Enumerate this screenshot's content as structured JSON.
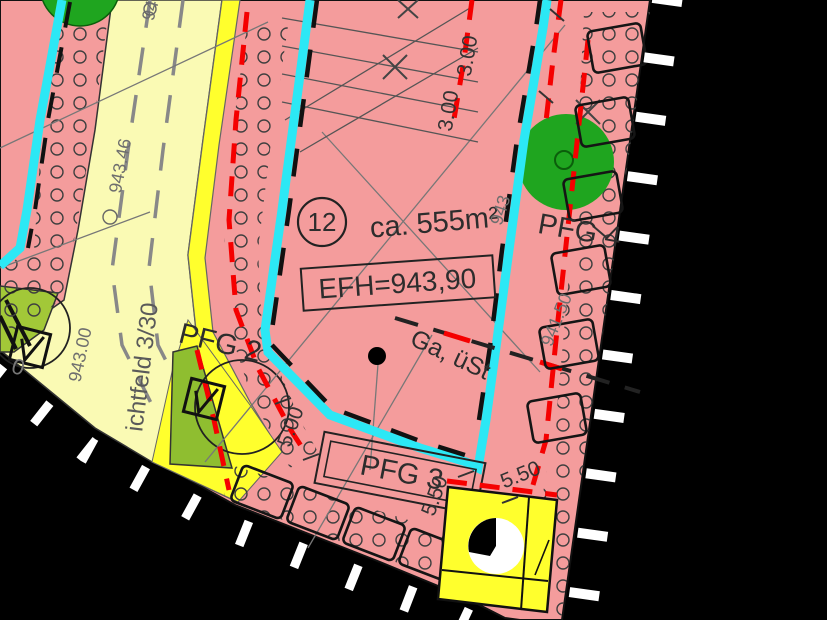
{
  "map": {
    "title": "zoning-plan-detail",
    "parcel": {
      "number": "12",
      "area_label": "ca. 555m²",
      "height_label": "EFH=943,90",
      "use_label": "Ga, üSt"
    },
    "zones": {
      "pfg2": "PFG 2",
      "pfg3": "PFG 3",
      "pfg4": "PFG 4"
    },
    "dimensions": {
      "d300a": "3.00",
      "d300b": "3.00",
      "d500": "5.00",
      "d550a": "5.50",
      "d550b": "5.50"
    },
    "elevations": {
      "e94346": "943.46",
      "e94300": "943.00",
      "e94150": "941.50",
      "e943_partial": "943",
      "e94_partial": "94",
      "e0_partial": "0"
    },
    "street_label": "ichtfeld 3/30",
    "colors": {
      "parcel_pink": "#f49c9c",
      "road_pale_yellow": "#fafab4",
      "strip_yellow": "#ffff2d",
      "green_area": "#a2c838",
      "tree_green": "#1fa51f",
      "water_cyan": "#2ce8f5",
      "boundary_red": "#f50000",
      "outside_black": "#000000"
    }
  }
}
